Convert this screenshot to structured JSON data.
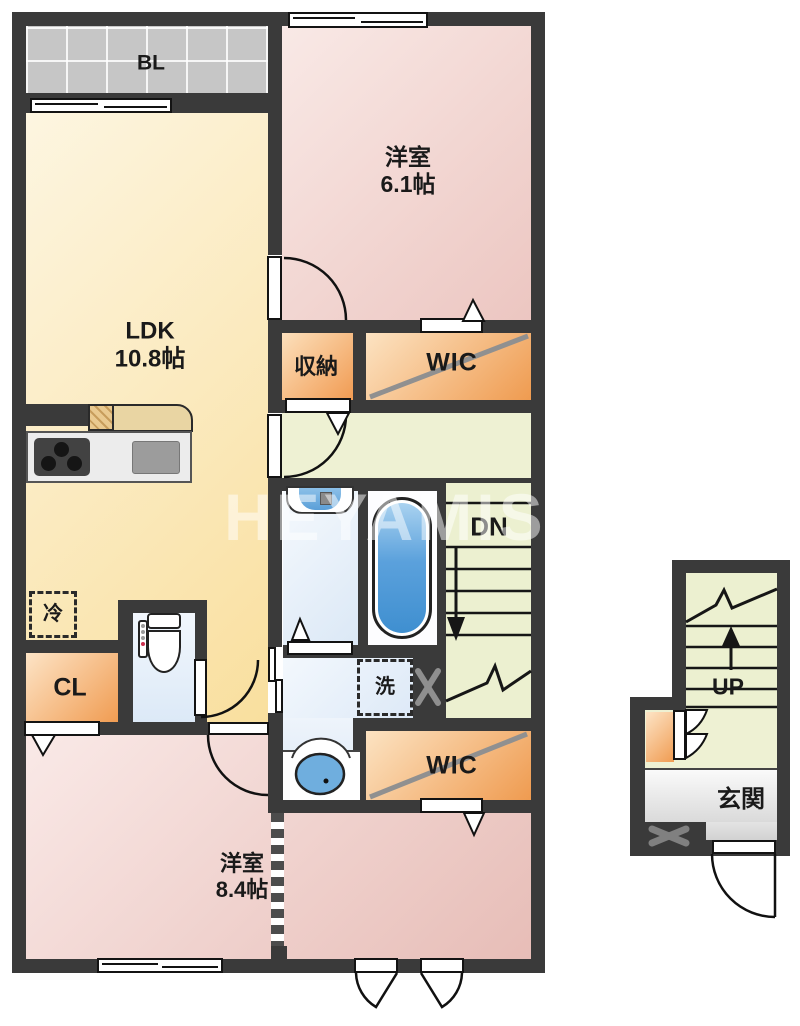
{
  "plan": {
    "watermark": "HEYAMIS",
    "unit_2f": {
      "balcony": "BL",
      "bedroom1": {
        "name": "洋室",
        "size": "6.1帖"
      },
      "ldk": {
        "name": "LDK",
        "size": "10.8帖"
      },
      "storage": "収納",
      "wic_upper": "WIC",
      "wic_lower": "WIC",
      "stairs_down": "DN",
      "washer": "洗",
      "fridge": "冷",
      "closet": "CL",
      "bedroom2": {
        "name": "洋室",
        "size": "8.4帖"
      }
    },
    "unit_1f": {
      "stairs_up": "UP",
      "entrance": "玄関"
    },
    "colors": {
      "wall": "#3a3a3a",
      "bedroom_pink": "#ecc6c1",
      "ldk_yellow": "#f9df9e",
      "closet_orange": "#f19b52",
      "corridor_green": "#eef1d3",
      "water_blue": "#dbe8f6",
      "tub_blue": "#4a94d2",
      "entrance_gray": "#dedede",
      "balcony_gray": "#c6c6c6"
    }
  }
}
